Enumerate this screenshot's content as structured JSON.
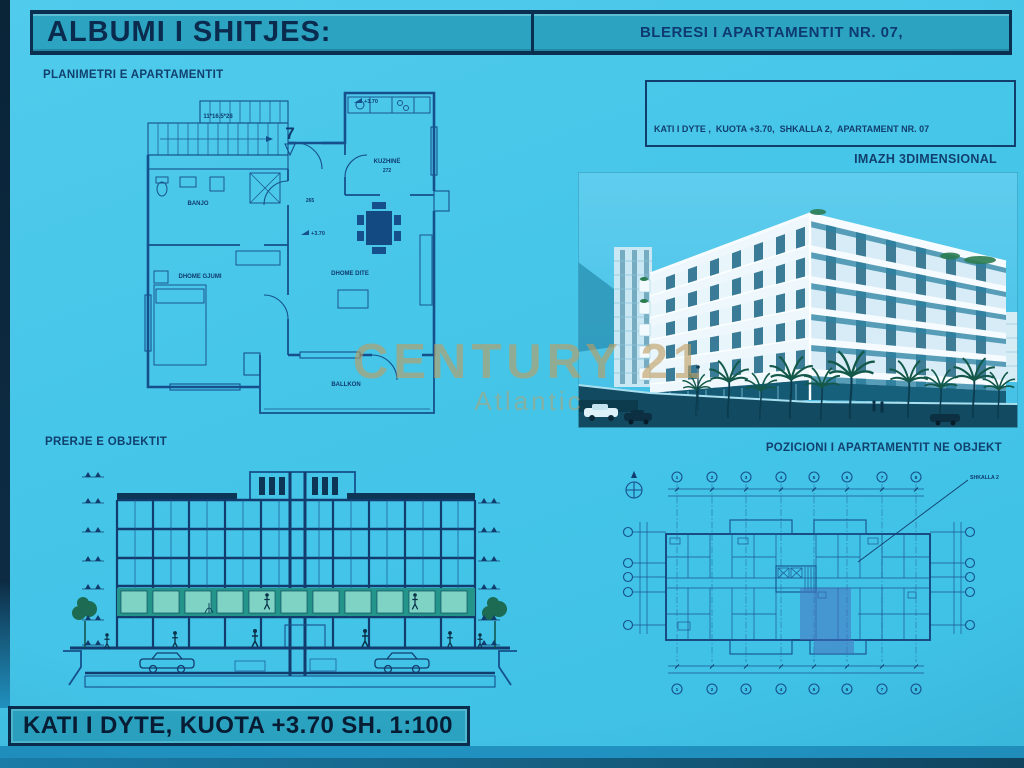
{
  "colors": {
    "background": "#45c6e9",
    "band": "#2ba3c1",
    "ink": "#123e6e",
    "dark_border": "#0b2f50",
    "drawing_line": "#16508c",
    "watermark_gold": "#c09a5e",
    "highlight_apartment": "#4a6cbe",
    "highlight_floor_teal": "#23958a"
  },
  "header": {
    "album_title": "ALBUMI I SHITJES:",
    "buyer_title": "BLERESI I APARTAMENTIT NR. 07,"
  },
  "watermark": {
    "brand": "CENTURY 21",
    "sub": "Atlantic"
  },
  "floor_plan": {
    "label": "PLANIMETRI E APARTAMENTIT",
    "apartment_number": "7",
    "stair_dim": "11*16.5*28",
    "elevation_mark": "+3.70",
    "rooms": {
      "bath": "BANJO",
      "kitchen": "KUZHINË",
      "bedroom": "DHOME GJUMI",
      "living": "DHOME DITE",
      "balcony": "BALLKON"
    },
    "dims": {
      "kitchen": "272",
      "hall": "265"
    }
  },
  "info_box": {
    "lines": [
      "KATI I DYTE ,  KUOTA +3.70,  SHKALLA 2,  APARTAMENT NR. 07",
      "SIPERFAQJA E AMBJENTIT TE APARTAMENTIT NR. 07 = 57.17m² (SIP. BALLKONI: 8.14)",
      "SIPERFAQJA PERBASHKET = 8.32 m²",
      "SIPERFAQJA TOTALE = 65.49 m²"
    ]
  },
  "render_3d": {
    "label": "IMAZH 3DIMENSIONAL"
  },
  "section_view": {
    "label": "PRERJE E OBJEKTIT"
  },
  "position_plan": {
    "label": "POZICIONI I APARTAMENTIT NE OBJEKT",
    "stair_callout": "SHKALLA 2",
    "grid_top": [
      "1",
      "2",
      "3",
      "4",
      "5",
      "6",
      "7",
      "8"
    ],
    "grid_bottom": [
      "1",
      "2",
      "3",
      "4",
      "5",
      "6",
      "7",
      "8"
    ]
  },
  "footer": {
    "caption": "KATI I DYTE, KUOTA +3.70 SH. 1:100"
  }
}
